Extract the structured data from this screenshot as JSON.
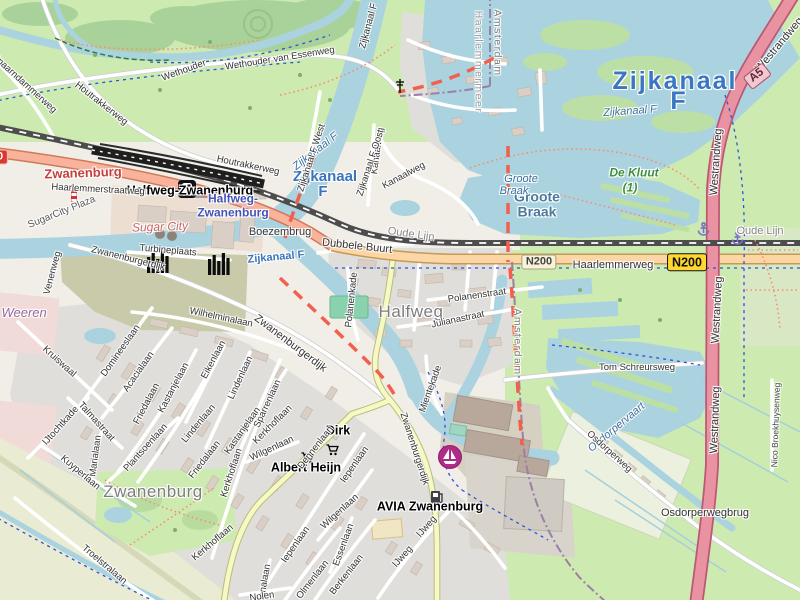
{
  "map": {
    "colors": {
      "water": "#aad3df",
      "grass": "#cdebb0",
      "forest": "#a9d29a",
      "residential": "#e0dedb",
      "building": "#d9cfc7",
      "motorway": "#e892a2",
      "trunk": "#f9b29c",
      "primary": "#fcd6a4",
      "secondary": "#f6f9c4",
      "railway": "#4d4d4d",
      "boundary_red": "#f2604d",
      "boundary_admin": "#9b7fa6",
      "cycleway": "#2d52dd",
      "footpath": "#fb8a70",
      "water_label": "#3a76c2",
      "reserve_label": "#3d8f3d",
      "marina_icon": "#b02a88",
      "anchor_icon": "#7b6fc9"
    },
    "badges": [
      {
        "ref": "N200",
        "style": "yellow",
        "x": 687,
        "y": 262,
        "rot": 0
      },
      {
        "ref": "N200",
        "style": "cream",
        "x": 539,
        "y": 262,
        "rot": 0
      },
      {
        "ref": "A5",
        "style": "motorway",
        "x": 757,
        "y": 76,
        "rot": -38
      },
      {
        "ref": "N200",
        "style": "red",
        "x": -10,
        "y": 157,
        "rot": 0
      }
    ],
    "pois": [
      {
        "name": "railway-station-icon",
        "icon": "station",
        "x": 178,
        "y": 180
      },
      {
        "name": "supermarket-cart-icon-dirk",
        "icon": "cart",
        "x": 326,
        "y": 444
      },
      {
        "name": "supermarket-cart-icon-albert-heijn",
        "icon": "cart",
        "x": 301,
        "y": 452
      },
      {
        "name": "fuel-pump-icon-avia",
        "icon": "fuel",
        "x": 430,
        "y": 490
      },
      {
        "name": "marina-sailboat-icon",
        "icon": "sailboat",
        "x": 437,
        "y": 444
      },
      {
        "name": "anchor-icon-1",
        "icon": "anchor",
        "x": 697,
        "y": 222
      },
      {
        "name": "anchor-icon-2",
        "icon": "anchor",
        "x": 731,
        "y": 231
      },
      {
        "name": "factory-chimneys-icon-1",
        "icon": "chimneys",
        "x": 147,
        "y": 251
      },
      {
        "name": "factory-chimneys-icon-2",
        "icon": "chimneys",
        "x": 208,
        "y": 253
      },
      {
        "name": "striped-tower-icon",
        "icon": "tower",
        "x": 71,
        "y": 190
      },
      {
        "name": "mast-icon",
        "icon": "mast",
        "x": 395,
        "y": 79
      }
    ],
    "labels": [
      {
        "text": "Zwanenburg",
        "x": 83,
        "y": 173,
        "rot": -2,
        "cls": "town-red"
      },
      {
        "text": "Halfweg-Zwanenburg",
        "x": 190,
        "y": 191,
        "rot": 0,
        "cls": "poi-bold"
      },
      {
        "text": "Halfweg-",
        "x": 233,
        "y": 199,
        "rot": 0,
        "cls": "station-blue"
      },
      {
        "text": "Zwanenburg",
        "x": 233,
        "y": 213,
        "rot": 0,
        "cls": "station-blue"
      },
      {
        "text": "Zijkanaal",
        "x": 325,
        "y": 177,
        "rot": 0,
        "cls": "water-bold"
      },
      {
        "text": "F",
        "x": 323,
        "y": 192,
        "rot": 0,
        "cls": "water-bold"
      },
      {
        "text": "Zijkanaal",
        "x": 675,
        "y": 81,
        "rot": 0,
        "cls": "water-big"
      },
      {
        "text": "F",
        "x": 679,
        "y": 101,
        "rot": 0,
        "cls": "water-big"
      },
      {
        "text": "Zijkanaal F",
        "x": 630,
        "y": 112,
        "rot": -4,
        "cls": "water-italic"
      },
      {
        "text": "Zijkanaal F",
        "x": 316,
        "y": 152,
        "rot": -38,
        "cls": "water-italic"
      },
      {
        "text": "Zijkanaal F",
        "x": 276,
        "y": 258,
        "rot": -5,
        "cls": "water-bold-sm"
      },
      {
        "text": "Halfweg",
        "x": 411,
        "y": 312,
        "rot": 0,
        "cls": "city-gray"
      },
      {
        "text": "Zwanenburg",
        "x": 153,
        "y": 492,
        "rot": 0,
        "cls": "city-gray"
      },
      {
        "text": "Groote",
        "x": 537,
        "y": 197,
        "rot": 0,
        "cls": "lake-bold"
      },
      {
        "text": "Braak",
        "x": 537,
        "y": 212,
        "rot": 0,
        "cls": "lake-bold"
      },
      {
        "text": "Groote",
        "x": 521,
        "y": 180,
        "rot": 0,
        "cls": "water-italic"
      },
      {
        "text": "Braak",
        "x": 514,
        "y": 192,
        "rot": 0,
        "cls": "water-italic"
      },
      {
        "text": "De Kluut",
        "x": 634,
        "y": 173,
        "rot": 0,
        "cls": "reserve"
      },
      {
        "text": "(1)",
        "x": 630,
        "y": 188,
        "rot": 0,
        "cls": "reserve"
      },
      {
        "text": "De Weeren",
        "x": 14,
        "y": 313,
        "rot": 0,
        "cls": "area-mauve"
      },
      {
        "text": "Amsterdam",
        "x": 497,
        "y": 43,
        "rot": 90,
        "cls": "boundary"
      },
      {
        "text": "Haarlemmermeer",
        "x": 478,
        "y": 62,
        "rot": 90,
        "cls": "boundary-light"
      },
      {
        "text": "Amsterdam",
        "x": 517,
        "y": 342,
        "rot": 90,
        "cls": "boundary"
      },
      {
        "text": "Sugar City",
        "x": 160,
        "y": 227,
        "rot": -2,
        "cls": "retail-italic"
      },
      {
        "text": "SugarCity Plaza",
        "x": 62,
        "y": 213,
        "rot": -22,
        "cls": "street-gray"
      },
      {
        "text": "Osdorpervaart",
        "x": 617,
        "y": 428,
        "rot": -40,
        "cls": "water-italic"
      },
      {
        "text": "Wethouder van Essenweg",
        "x": 280,
        "y": 59,
        "rot": -9,
        "cls": "street"
      },
      {
        "text": "Wethouder",
        "x": 184,
        "y": 71,
        "rot": -20,
        "cls": "street"
      },
      {
        "text": "Houtrakkerweg",
        "x": 101,
        "y": 104,
        "rot": 38,
        "cls": "street"
      },
      {
        "text": "Houtrakkerweg",
        "x": 248,
        "y": 166,
        "rot": 12,
        "cls": "street"
      },
      {
        "text": "Spaarndammerweg",
        "x": 24,
        "y": 84,
        "rot": 42,
        "cls": "street"
      },
      {
        "text": "Haarlemmerstraatweg",
        "x": 98,
        "y": 190,
        "rot": 3,
        "cls": "street"
      },
      {
        "text": "Haarlemmerweg",
        "x": 613,
        "y": 266,
        "rot": 0,
        "cls": "street-lg"
      },
      {
        "text": "Zwanenburgerdijk",
        "x": 290,
        "y": 344,
        "rot": 37,
        "cls": "street-lg"
      },
      {
        "text": "Zwanenburgerdijk",
        "x": 128,
        "y": 259,
        "rot": 14,
        "cls": "street"
      },
      {
        "text": "Zwanenburgerdijk",
        "x": 414,
        "y": 449,
        "rot": 72,
        "cls": "street"
      },
      {
        "text": "Venenweg",
        "x": 53,
        "y": 273,
        "rot": -75,
        "cls": "street"
      },
      {
        "text": "Kruiswaal",
        "x": 59,
        "y": 362,
        "rot": 42,
        "cls": "street"
      },
      {
        "text": "Domineeslaan",
        "x": 121,
        "y": 351,
        "rot": -55,
        "cls": "street"
      },
      {
        "text": "Acacialaan",
        "x": 139,
        "y": 372,
        "rot": -55,
        "cls": "street"
      },
      {
        "text": "Friedalaan",
        "x": 147,
        "y": 404,
        "rot": -62,
        "cls": "street"
      },
      {
        "text": "Friedalaan",
        "x": 205,
        "y": 460,
        "rot": -52,
        "cls": "street"
      },
      {
        "text": "Wilhelminalaan",
        "x": 221,
        "y": 318,
        "rot": 12,
        "cls": "street"
      },
      {
        "text": "Kastanjelaan",
        "x": 174,
        "y": 388,
        "rot": -62,
        "cls": "street"
      },
      {
        "text": "Kastanjelaan",
        "x": 243,
        "y": 431,
        "rot": -55,
        "cls": "street"
      },
      {
        "text": "Eikenlaan",
        "x": 214,
        "y": 360,
        "rot": -62,
        "cls": "street"
      },
      {
        "text": "Lindenlaan",
        "x": 241,
        "y": 378,
        "rot": -65,
        "cls": "street"
      },
      {
        "text": "Lindenlaan",
        "x": 199,
        "y": 424,
        "rot": -50,
        "cls": "street"
      },
      {
        "text": "Sparrenlaan",
        "x": 268,
        "y": 404,
        "rot": -65,
        "cls": "street"
      },
      {
        "text": "Kerkhoflaan",
        "x": 232,
        "y": 473,
        "rot": -72,
        "cls": "street"
      },
      {
        "text": "Kerkhoflaan",
        "x": 273,
        "y": 425,
        "rot": -45,
        "cls": "street"
      },
      {
        "text": "Kerkhoflaan",
        "x": 213,
        "y": 543,
        "rot": -40,
        "cls": "street"
      },
      {
        "text": "Plantsoenlaan",
        "x": 146,
        "y": 448,
        "rot": -48,
        "cls": "street"
      },
      {
        "text": "Marialaan",
        "x": 96,
        "y": 456,
        "rot": -82,
        "cls": "street"
      },
      {
        "text": "Kuyperlaan",
        "x": 80,
        "y": 473,
        "rot": 40,
        "cls": "street"
      },
      {
        "text": "IJtochtkade",
        "x": 61,
        "y": 426,
        "rot": -48,
        "cls": "street"
      },
      {
        "text": "Talmastraat",
        "x": 96,
        "y": 422,
        "rot": 48,
        "cls": "street"
      },
      {
        "text": "Troelstralaan",
        "x": 104,
        "y": 565,
        "rot": 40,
        "cls": "street"
      },
      {
        "text": "Polanenkade",
        "x": 352,
        "y": 300,
        "rot": -84,
        "cls": "street"
      },
      {
        "text": "Polanenstraat",
        "x": 477,
        "y": 296,
        "rot": -8,
        "cls": "street"
      },
      {
        "text": "Julianastraat",
        "x": 458,
        "y": 320,
        "rot": -12,
        "cls": "street"
      },
      {
        "text": "Mientekade",
        "x": 431,
        "y": 389,
        "rot": -70,
        "cls": "street"
      },
      {
        "text": "Kanaalweg",
        "x": 404,
        "y": 176,
        "rot": -28,
        "cls": "street"
      },
      {
        "text": "Kanaalweg",
        "x": 378,
        "y": 151,
        "rot": -82,
        "cls": "street"
      },
      {
        "text": "Zijkanaal F West",
        "x": 312,
        "y": 158,
        "rot": -72,
        "cls": "street"
      },
      {
        "text": "Zijkanaal F Oost",
        "x": 371,
        "y": 163,
        "rot": -72,
        "cls": "street"
      },
      {
        "text": "Zijkanaal F",
        "x": 369,
        "y": 26,
        "rot": -75,
        "cls": "street"
      },
      {
        "text": "Dubbele Buurt",
        "x": 357,
        "y": 247,
        "rot": 6,
        "cls": "street-lg"
      },
      {
        "text": "Oude Lijn",
        "x": 411,
        "y": 235,
        "rot": 8,
        "cls": "rail-gray"
      },
      {
        "text": "Oude Lijn",
        "x": 760,
        "y": 232,
        "rot": 0,
        "cls": "rail-gray"
      },
      {
        "text": "Westrandweg",
        "x": 780,
        "y": 45,
        "rot": -50,
        "cls": "street-lg"
      },
      {
        "text": "Westrandweg",
        "x": 717,
        "y": 162,
        "rot": -86,
        "cls": "street-lg"
      },
      {
        "text": "Westrandweg",
        "x": 718,
        "y": 310,
        "rot": -87,
        "cls": "street-lg"
      },
      {
        "text": "Westrandweg",
        "x": 716,
        "y": 420,
        "rot": -88,
        "cls": "street-lg"
      },
      {
        "text": "Tom Schreursweg",
        "x": 637,
        "y": 368,
        "rot": 0,
        "cls": "street"
      },
      {
        "text": "Osdorperweg",
        "x": 609,
        "y": 452,
        "rot": 42,
        "cls": "street"
      },
      {
        "text": "Osdorperwegbrug",
        "x": 705,
        "y": 514,
        "rot": 0,
        "cls": "street-lg"
      },
      {
        "text": "Nico Broekhuysenweg",
        "x": 776,
        "y": 425,
        "rot": -88,
        "cls": "street-sm"
      },
      {
        "text": "Dirk",
        "x": 338,
        "y": 431,
        "rot": 0,
        "cls": "poi-bold"
      },
      {
        "text": "Albert Heijn",
        "x": 306,
        "y": 468,
        "rot": 0,
        "cls": "poi-bold"
      },
      {
        "text": "AVIA Zwanenburg",
        "x": 430,
        "y": 507,
        "rot": 0,
        "cls": "poi-bold"
      },
      {
        "text": "Dennenlaan",
        "x": 316,
        "y": 448,
        "rot": -52,
        "cls": "street"
      },
      {
        "text": "Iepenlaan",
        "x": 355,
        "y": 465,
        "rot": -55,
        "cls": "street"
      },
      {
        "text": "Iepenlaan",
        "x": 296,
        "y": 545,
        "rot": -55,
        "cls": "street"
      },
      {
        "text": "Wilgenlaan",
        "x": 340,
        "y": 512,
        "rot": -42,
        "cls": "street"
      },
      {
        "text": "Wilgenlaan",
        "x": 272,
        "y": 449,
        "rot": -25,
        "cls": "street"
      },
      {
        "text": "Essenlaan",
        "x": 344,
        "y": 545,
        "rot": -70,
        "cls": "street"
      },
      {
        "text": "Berkenlaan",
        "x": 347,
        "y": 575,
        "rot": -52,
        "cls": "street"
      },
      {
        "text": "Olmenlaan",
        "x": 313,
        "y": 580,
        "rot": -52,
        "cls": "street"
      },
      {
        "text": "Julianalaan",
        "x": 264,
        "y": 588,
        "rot": -80,
        "cls": "street"
      },
      {
        "text": "IJweg",
        "x": 403,
        "y": 557,
        "rot": -48,
        "cls": "street"
      },
      {
        "text": "IJweg",
        "x": 427,
        "y": 527,
        "rot": -48,
        "cls": "street"
      },
      {
        "text": "Turbineplaats",
        "x": 168,
        "y": 251,
        "rot": 5,
        "cls": "street"
      },
      {
        "text": "Nolen",
        "x": 262,
        "y": 597,
        "rot": -8,
        "cls": "street"
      },
      {
        "text": "Boezembrug",
        "x": 280,
        "y": 233,
        "rot": 0,
        "cls": "street-lg"
      }
    ]
  }
}
